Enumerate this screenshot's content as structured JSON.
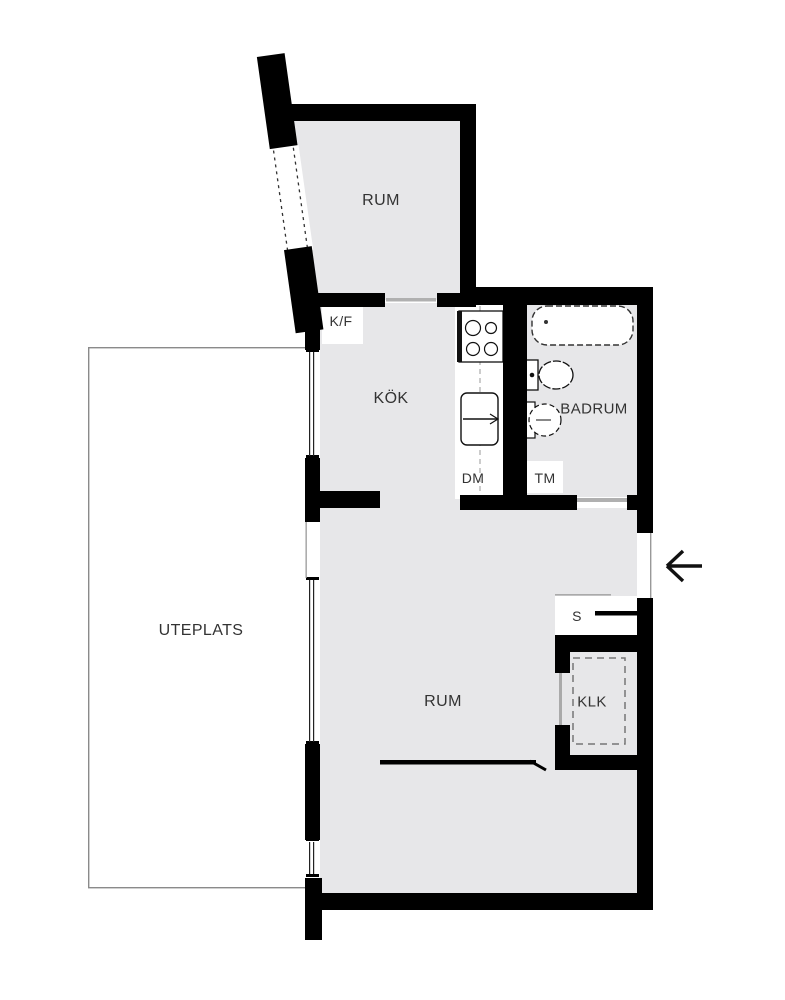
{
  "plan": {
    "type": "floor-plan",
    "rooms": {
      "room_top": {
        "label": "RUM"
      },
      "kitchen": {
        "label": "KÖK"
      },
      "bathroom": {
        "label": "BADRUM"
      },
      "room_main": {
        "label": "RUM"
      },
      "closet": {
        "label": "KLK"
      },
      "patio": {
        "label": "UTEPLATS"
      }
    },
    "fixtures": {
      "fridge_freezer": {
        "label": "K/F"
      },
      "dishwasher": {
        "label": "DM"
      },
      "washing_machine": {
        "label": "TM"
      },
      "cabinet": {
        "label": "S"
      }
    },
    "icons": {
      "entrance_arrow": "left-arrow",
      "stove": "4-burner-stove",
      "kitchen_sink": "sink-with-faucet",
      "bathtub": "bathtub",
      "toilet": "toilet",
      "bathroom_sink": "round-sink"
    },
    "colors": {
      "floor": "#e7e7e9",
      "wall": "#000000",
      "threshold": "#b0b0b0",
      "text": "#333333",
      "patio_border": "#8a8a8a"
    }
  }
}
